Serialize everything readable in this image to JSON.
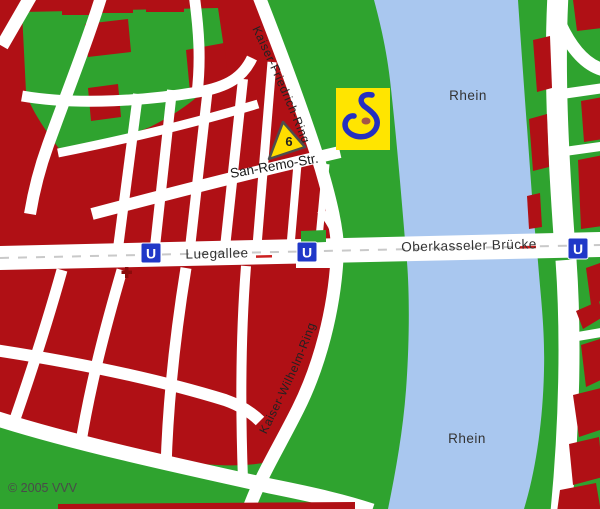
{
  "map": {
    "copyright": "© 2005 VVV",
    "river_label_upper": "Rhein",
    "river_label_lower": "Rhein",
    "streets": {
      "luegallee": "Luegallee",
      "oberkasseler_bruecke": "Oberkasseler Brücke",
      "kaiser_friedrich_ring": "Kaiser-Friedrich-Ring",
      "kaiser_wilhelm_ring": "Kaiser-Wilhelm-Ring",
      "san_remo_str": "San-Remo-Str."
    },
    "marker": {
      "route_number": "6"
    },
    "stations": {
      "label": "U"
    },
    "colors": {
      "land_green": "#2FA32F",
      "building_red": "#B01015",
      "river_blue": "#A9C7EF",
      "road_white": "#FFFFFF",
      "ubahn_blue": "#2038C8",
      "marker_yellow": "#FFDD00",
      "marker_outline": "#4D4D4D",
      "logo_yellow": "#FFE500",
      "logo_blue": "#2430C0",
      "logo_dot": "#A35648",
      "label_dark": "#333333",
      "dash_gray": "#C9C9C9",
      "dash_red": "#CC2020",
      "church_red": "#8B0B0B"
    }
  }
}
